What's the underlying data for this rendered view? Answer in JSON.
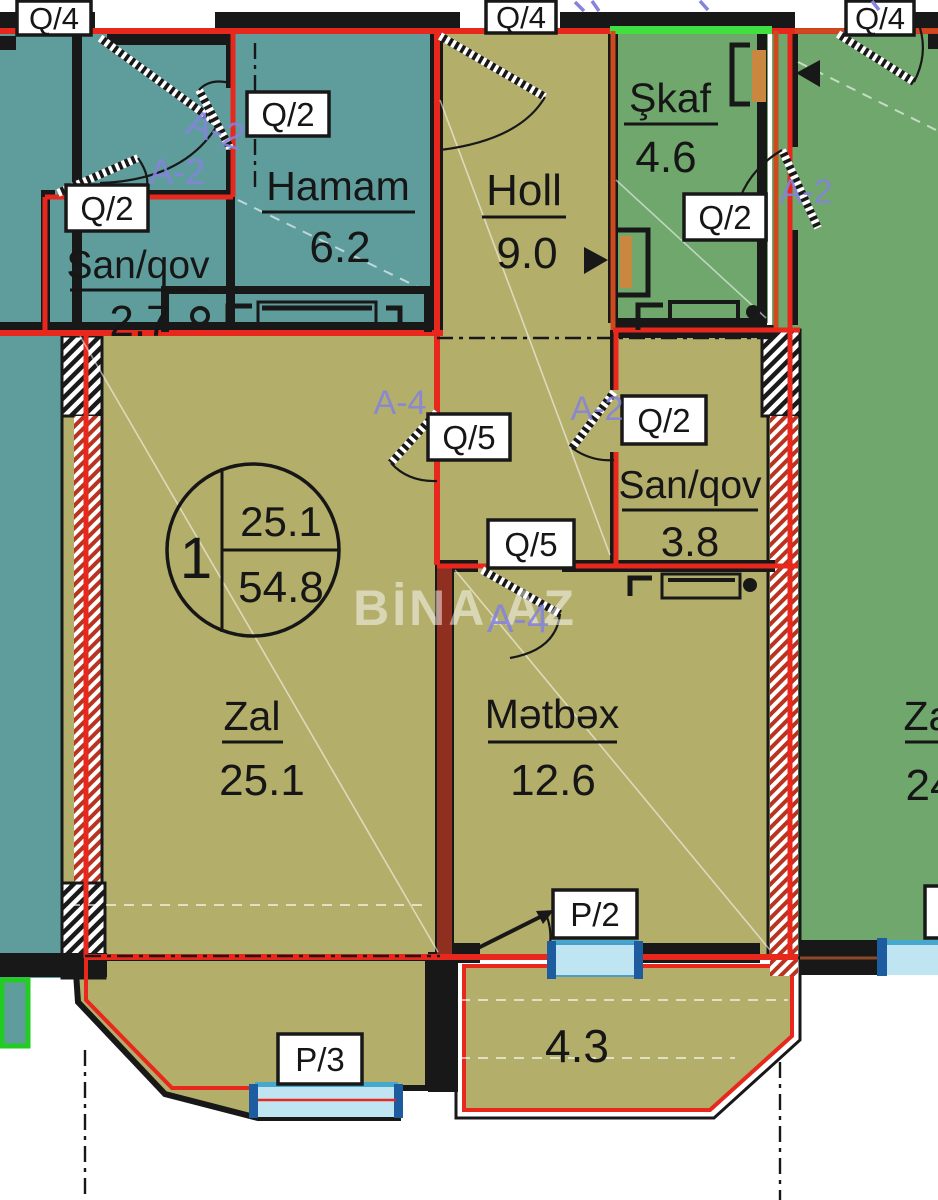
{
  "watermark": "BİNA.AZ",
  "unit": {
    "number": "1",
    "living_area": "25.1",
    "total_area": "54.8"
  },
  "rooms": {
    "hamam": {
      "name": "Hamam",
      "area": "6.2"
    },
    "san_qov_left": {
      "name": "San/qov",
      "area": "2.7"
    },
    "holl": {
      "name": "Holl",
      "area": "9.0"
    },
    "skaf": {
      "name": "Şkaf",
      "area": "4.6"
    },
    "san_qov_right": {
      "name": "San/qov",
      "area": "3.8"
    },
    "zal": {
      "name": "Zal",
      "area": "25.1"
    },
    "metbex": {
      "name": "Mətbəx",
      "area": "12.6"
    },
    "balcony": {
      "area": "4.3"
    },
    "neighbor_zal": {
      "name": "Zal",
      "area": "24"
    }
  },
  "door_labels": {
    "q4_left": "Q/4",
    "q4_middle": "Q/4",
    "q4_right": "Q/4",
    "q2_hamam": "Q/2",
    "q2_san_qov_left": "Q/2",
    "q2_skaf": "Q/2",
    "q2_san_qov_right": "Q/2",
    "q5_zal": "Q/5",
    "q5_metbex": "Q/5",
    "p2": "P/2",
    "p3": "P/3"
  },
  "section_marks": {
    "a2_hamam": "A-2",
    "a2_san_qov": "A-2",
    "a2_right": "A-2",
    "a2_middle": "A-2",
    "a4_holl": "A-4",
    "a4_metbex": "A-4"
  },
  "colors": {
    "teal": "#5f9d9d",
    "olive": "#b4ae6b",
    "green": "#6fa76d",
    "wall_black": "#181818",
    "red": "#e8281c",
    "orange_red": "#cc4a1e",
    "dark_red_wall": "#8e2f1f",
    "purple": "#8583dc",
    "window_blue": "#bfe4f2",
    "window_blue_dark": "#1d5c9e",
    "window_teal": "#46a8cc",
    "bright_green": "#3fe03f",
    "bright_green_border": "#22cc22",
    "door_orange": "#c9873f",
    "label_ink": "#161616"
  }
}
